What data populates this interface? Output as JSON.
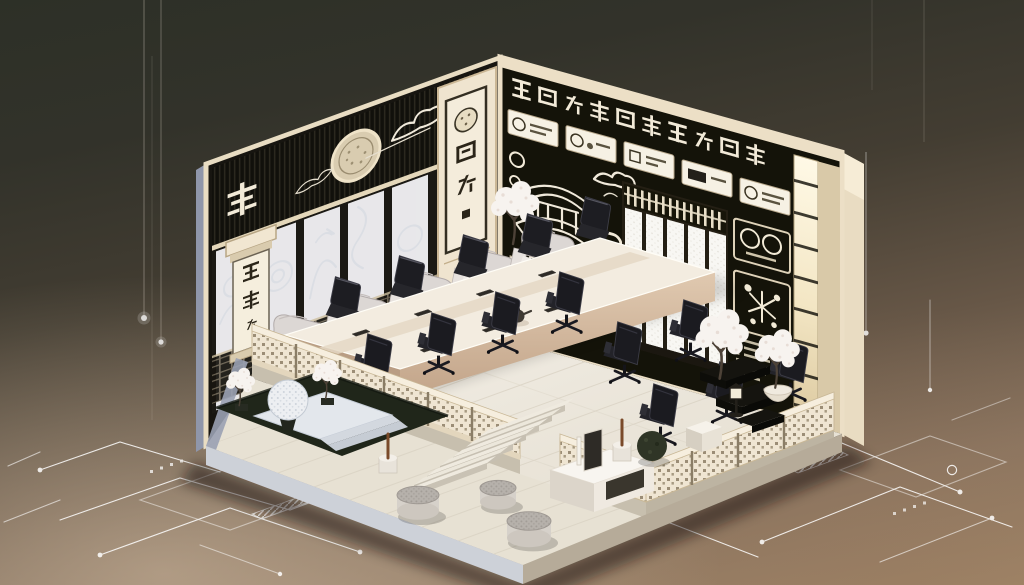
{
  "scene": {
    "description": "Isometric cutaway illustration of a Japanese-styled executive meeting room: black walls with cream trim, calligraphy banners, a pagoda line-art mural, shoji screens, a long conference table with black office chairs, cream lounge armchairs, white blossom bonsai trees, a sunken rock garden, and white circuit-board traces glowing on a dark bronze backdrop."
  },
  "calligraphy": {
    "left_wall_frieze_char": "秉",
    "hanging_scroll_chars": "談閒",
    "pillar_banner_chars": "族闍衍",
    "top_frieze_text": "三回光久同米目关虫津",
    "mural_banner_text": "公亀雲"
  },
  "wall_art": {
    "left_wall_icons": [
      "round-medallion-icon",
      "cloud-wave-icon",
      "frosted-swirl-panels"
    ],
    "mural_icons": [
      "pagoda-line-art",
      "cloud-swirl-icon",
      "seal-circle-icon",
      "chip-badge-icon",
      "mountain-line-art"
    ],
    "plaques": {
      "count": 5,
      "icon": "ink-seal-icon"
    },
    "right_panels": [
      "twin-seal-diagram",
      "starburst-diagram"
    ],
    "list_rows": 6
  },
  "furniture": {
    "conference_chairs": 14,
    "lounge_armchairs": 5,
    "table_tablets": 7,
    "poufs": 3,
    "blossom_trees": 5,
    "teapot": 1
  },
  "colors": {
    "background_top": "#2d3027",
    "background_bottom": "#a28768",
    "wall_dark": "#16140e",
    "trim_cream": "#ecdfc5",
    "floor_light": "#efeae0",
    "blossom_white": "#f7f3ef",
    "chair_black": "#1d1d21",
    "circuit_white": "#ffffff",
    "garden_dark": "#20261a"
  }
}
